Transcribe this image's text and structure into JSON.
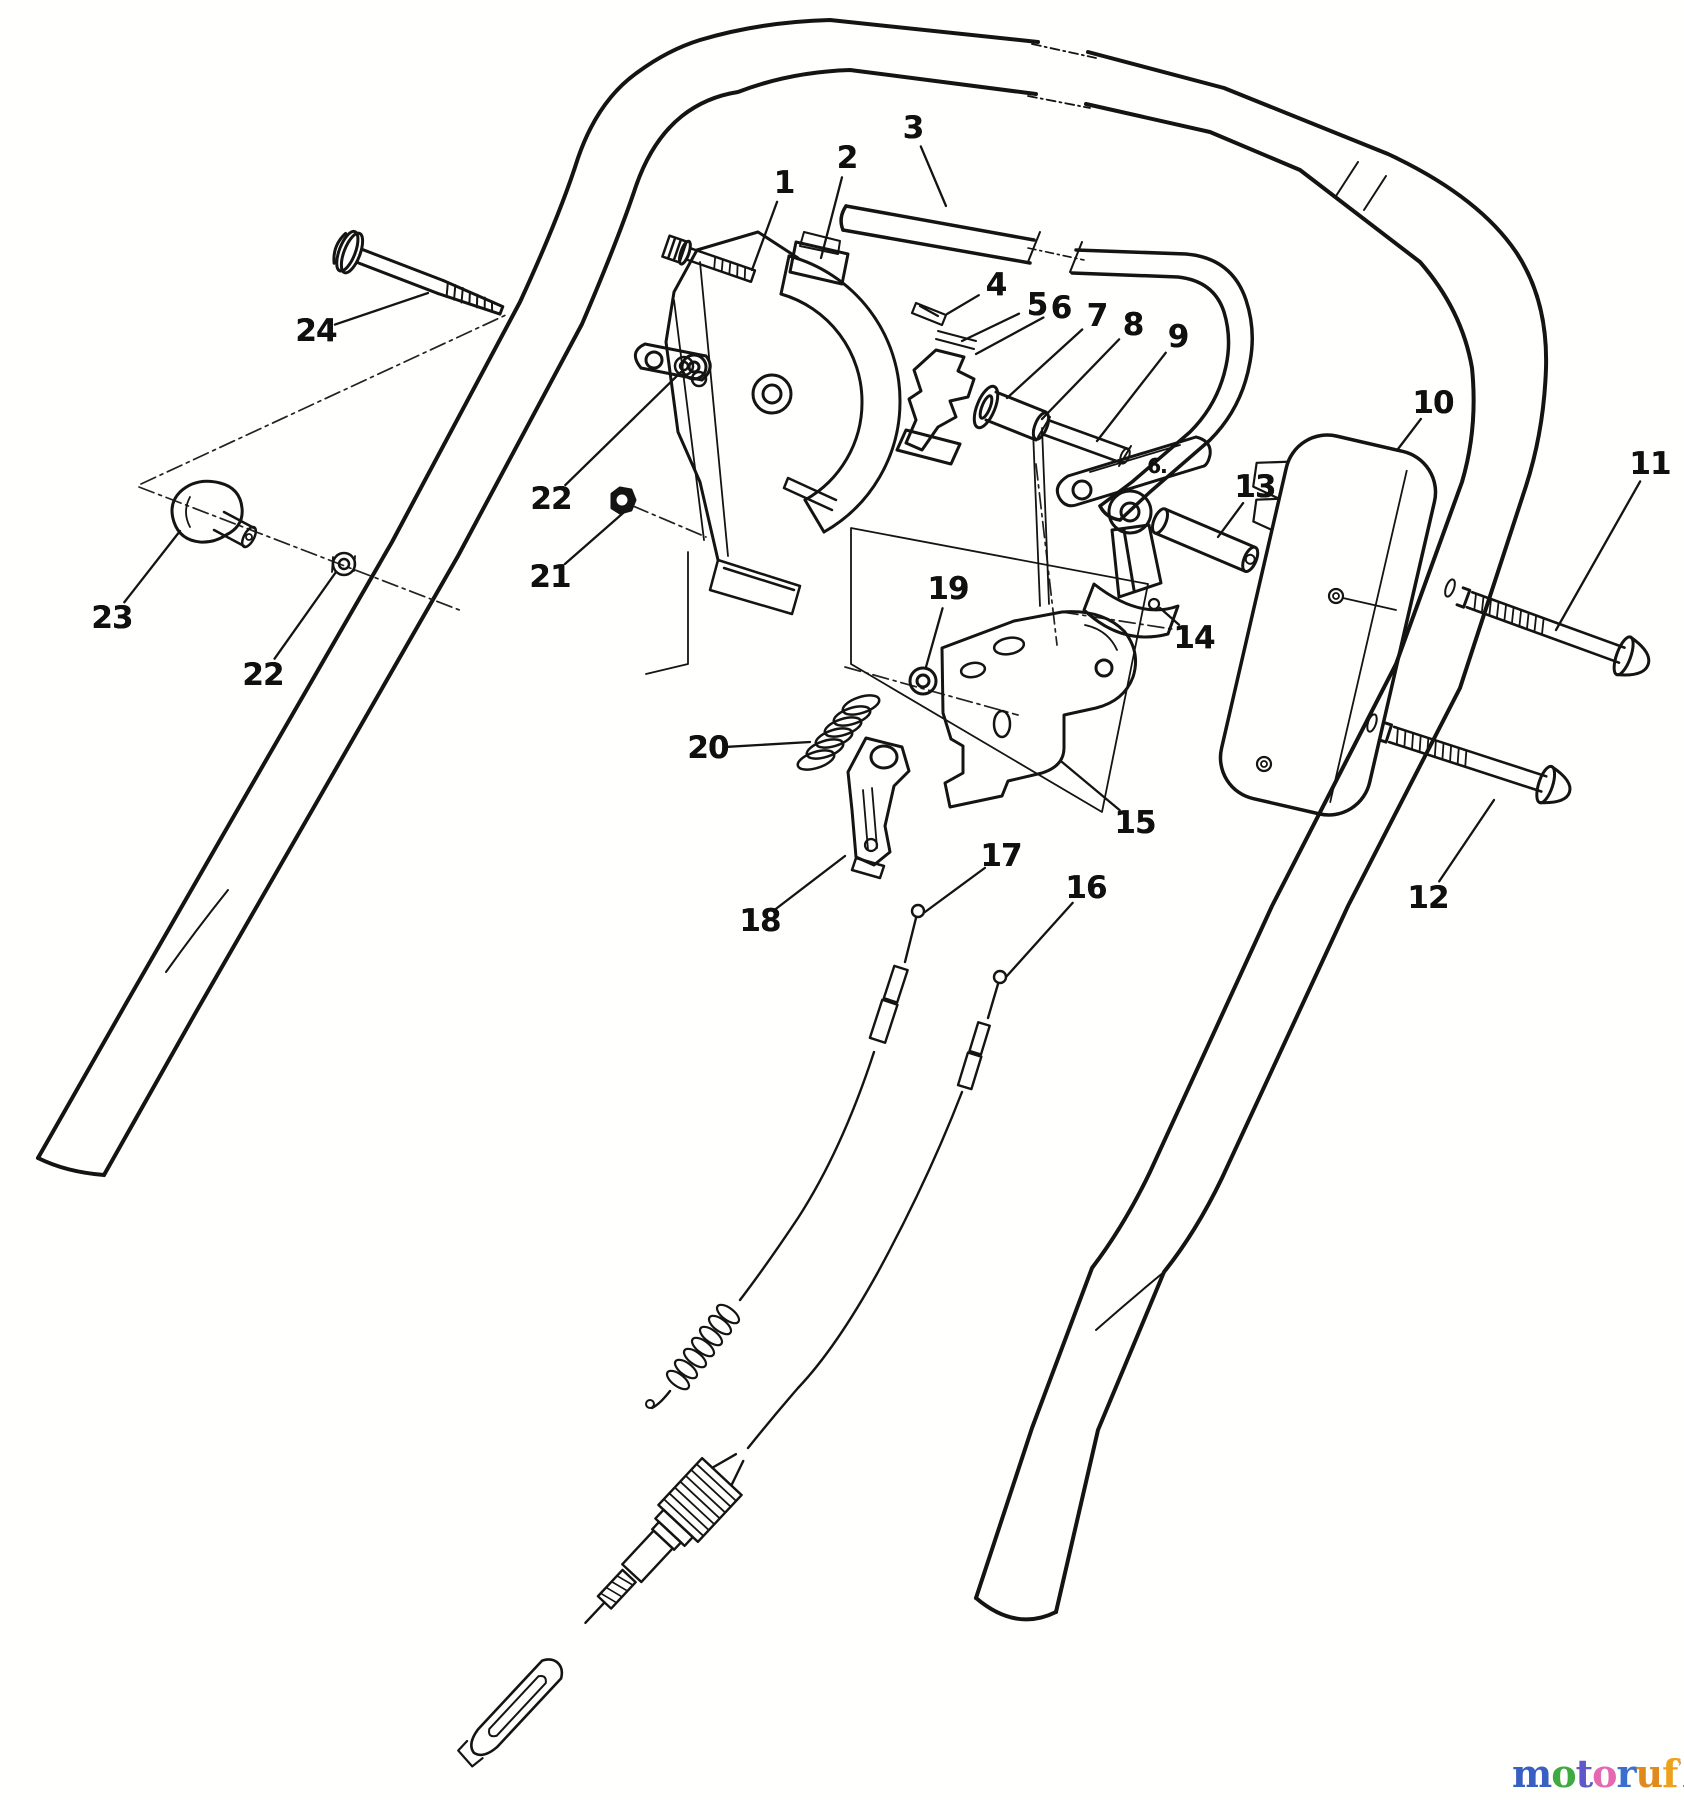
{
  "canvas": {
    "width": 1684,
    "height": 1800
  },
  "figure": {
    "type": "exploded-parts-diagram",
    "subject": "mower handle traction / speed control assembly",
    "line_color": "#141414",
    "background": "#fffffe"
  },
  "callouts": [
    {
      "id": "1",
      "label": "1",
      "x": 784,
      "y": 183,
      "tx": 752,
      "ty": 270
    },
    {
      "id": "2",
      "label": "2",
      "x": 847,
      "y": 158,
      "tx": 821,
      "ty": 258
    },
    {
      "id": "3",
      "label": "3",
      "x": 913,
      "y": 128,
      "tx": 946,
      "ty": 206
    },
    {
      "id": "4",
      "label": "4",
      "x": 996,
      "y": 285,
      "tx": 947,
      "ty": 314
    },
    {
      "id": "5",
      "label": "5",
      "x": 1037,
      "y": 305,
      "tx": 962,
      "ty": 341
    },
    {
      "id": "6",
      "label": "6",
      "x": 1061,
      "y": 308,
      "tx": 976,
      "ty": 354
    },
    {
      "id": "7",
      "label": "7",
      "x": 1097,
      "y": 316,
      "tx": 1007,
      "ty": 398
    },
    {
      "id": "8",
      "label": "8",
      "x": 1133,
      "y": 325,
      "tx": 1042,
      "ty": 419
    },
    {
      "id": "9",
      "label": "9",
      "x": 1178,
      "y": 337,
      "tx": 1097,
      "ty": 441
    },
    {
      "id": "10",
      "label": "10",
      "x": 1433,
      "y": 403,
      "tx": 1398,
      "ty": 449
    },
    {
      "id": "11",
      "label": "11",
      "x": 1650,
      "y": 464,
      "tx": 1556,
      "ty": 630
    },
    {
      "id": "12",
      "label": "12",
      "x": 1428,
      "y": 898,
      "tx": 1494,
      "ty": 800
    },
    {
      "id": "13",
      "label": "13",
      "x": 1255,
      "y": 487,
      "tx": 1218,
      "ty": 537
    },
    {
      "id": "14",
      "label": "14",
      "x": 1194,
      "y": 638,
      "tx": 1160,
      "ty": 608
    },
    {
      "id": "15",
      "label": "15",
      "x": 1135,
      "y": 823,
      "tx": 1062,
      "ty": 762
    },
    {
      "id": "16",
      "label": "16",
      "x": 1086,
      "y": 888,
      "tx": 1006,
      "ty": 977
    },
    {
      "id": "17",
      "label": "17",
      "x": 1001,
      "y": 856,
      "tx": 925,
      "ty": 912
    },
    {
      "id": "18",
      "label": "18",
      "x": 760,
      "y": 921,
      "tx": 845,
      "ty": 856
    },
    {
      "id": "19",
      "label": "19",
      "x": 948,
      "y": 589,
      "tx": 926,
      "ty": 667
    },
    {
      "id": "20",
      "label": "20",
      "x": 708,
      "y": 748,
      "tx": 810,
      "ty": 742
    },
    {
      "id": "21",
      "label": "21",
      "x": 550,
      "y": 577,
      "tx": 630,
      "ty": 507
    },
    {
      "id": "22a",
      "label": "22",
      "x": 551,
      "y": 499,
      "tx": 681,
      "ty": 372
    },
    {
      "id": "22b",
      "label": "22",
      "x": 263,
      "y": 675,
      "tx": 336,
      "ty": 572
    },
    {
      "id": "23",
      "label": "23",
      "x": 112,
      "y": 618,
      "tx": 180,
      "ty": 531
    },
    {
      "id": "24",
      "label": "24",
      "x": 316,
      "y": 331,
      "tx": 428,
      "ty": 293
    },
    {
      "id": "6b",
      "label": "6.",
      "x": 1157,
      "y": 466,
      "small": true
    }
  ],
  "watermark": {
    "letters": [
      {
        "ch": "m",
        "color": "#3a5fc2"
      },
      {
        "ch": "o",
        "color": "#3faa3f"
      },
      {
        "ch": "t",
        "color": "#6157c8"
      },
      {
        "ch": "o",
        "color": "#e668b0"
      },
      {
        "ch": "r",
        "color": "#3a6fd0"
      },
      {
        "ch": "u",
        "color": "#e08a1e"
      },
      {
        "ch": "f",
        "color": "#eda21b"
      }
    ],
    "tick": "’",
    "tick_color": "#9a9a9a",
    "suffix": ".de",
    "suffix_color": "#4a4a4a"
  }
}
